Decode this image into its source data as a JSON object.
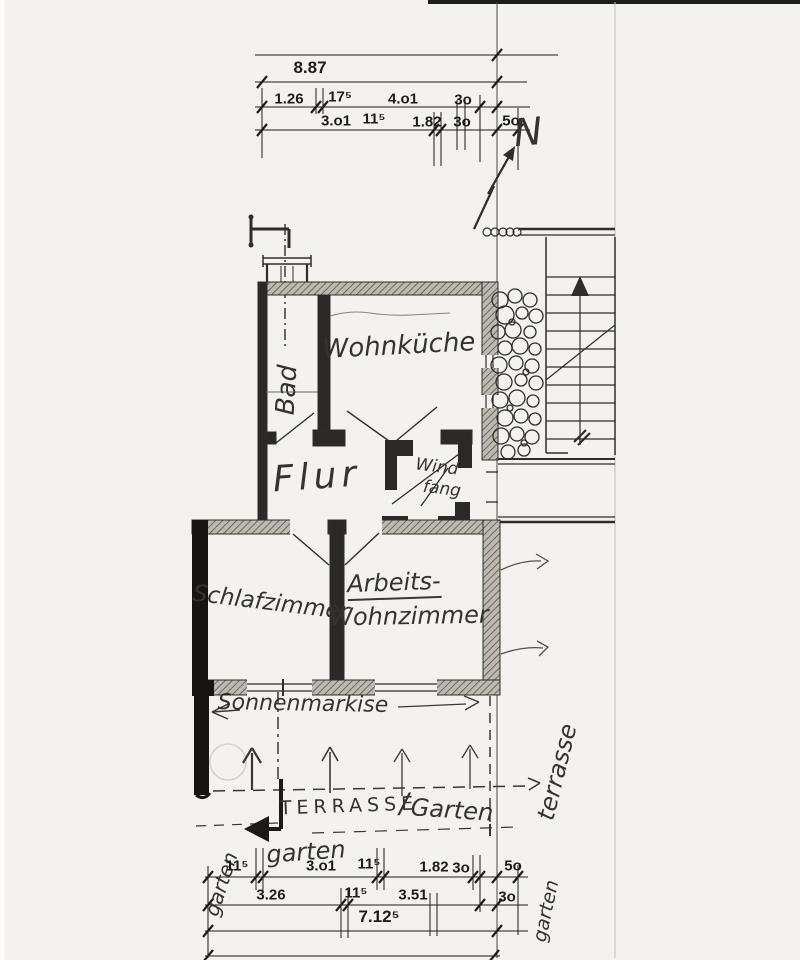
{
  "page": {
    "paper_color": "#f3f2ef",
    "ink_color": "#2f2d2b",
    "wall_fill": "#262422"
  },
  "north": {
    "label": "N"
  },
  "top_dimensions": {
    "total": "8.87",
    "row1": [
      "1.26",
      "17⁵",
      "4.o1",
      "3o"
    ],
    "row2": [
      "3.o1",
      "11⁵",
      "1.82",
      "3o",
      "5o"
    ]
  },
  "rooms": {
    "bad": "Bad",
    "wohnkueche": "Wohnküche",
    "flur": "Flur",
    "windfang_line1": "Wind",
    "windfang_line2": "fang",
    "schlafzimmer": "Schlafzimmer",
    "arbeitszimmer_line1": "Arbeits-",
    "arbeitszimmer_line2": "Wohnzimmer"
  },
  "annotations": {
    "sonnenmarkise": "Sonnenmarkise",
    "terrasse": "TERRASSE",
    "separator": "/",
    "garten_script": "Garten",
    "garten_below": "garten",
    "garten_left": "garten",
    "terrasse_right": "terrasse",
    "garten_right": "garten"
  },
  "bottom_dimensions": {
    "row1": [
      "11⁵",
      "3.o1",
      "11⁵",
      "1.82",
      "3o",
      "5o"
    ],
    "row2": [
      "3.26",
      "11⁵",
      "3.51",
      "3o"
    ],
    "total": "7.12⁵"
  }
}
